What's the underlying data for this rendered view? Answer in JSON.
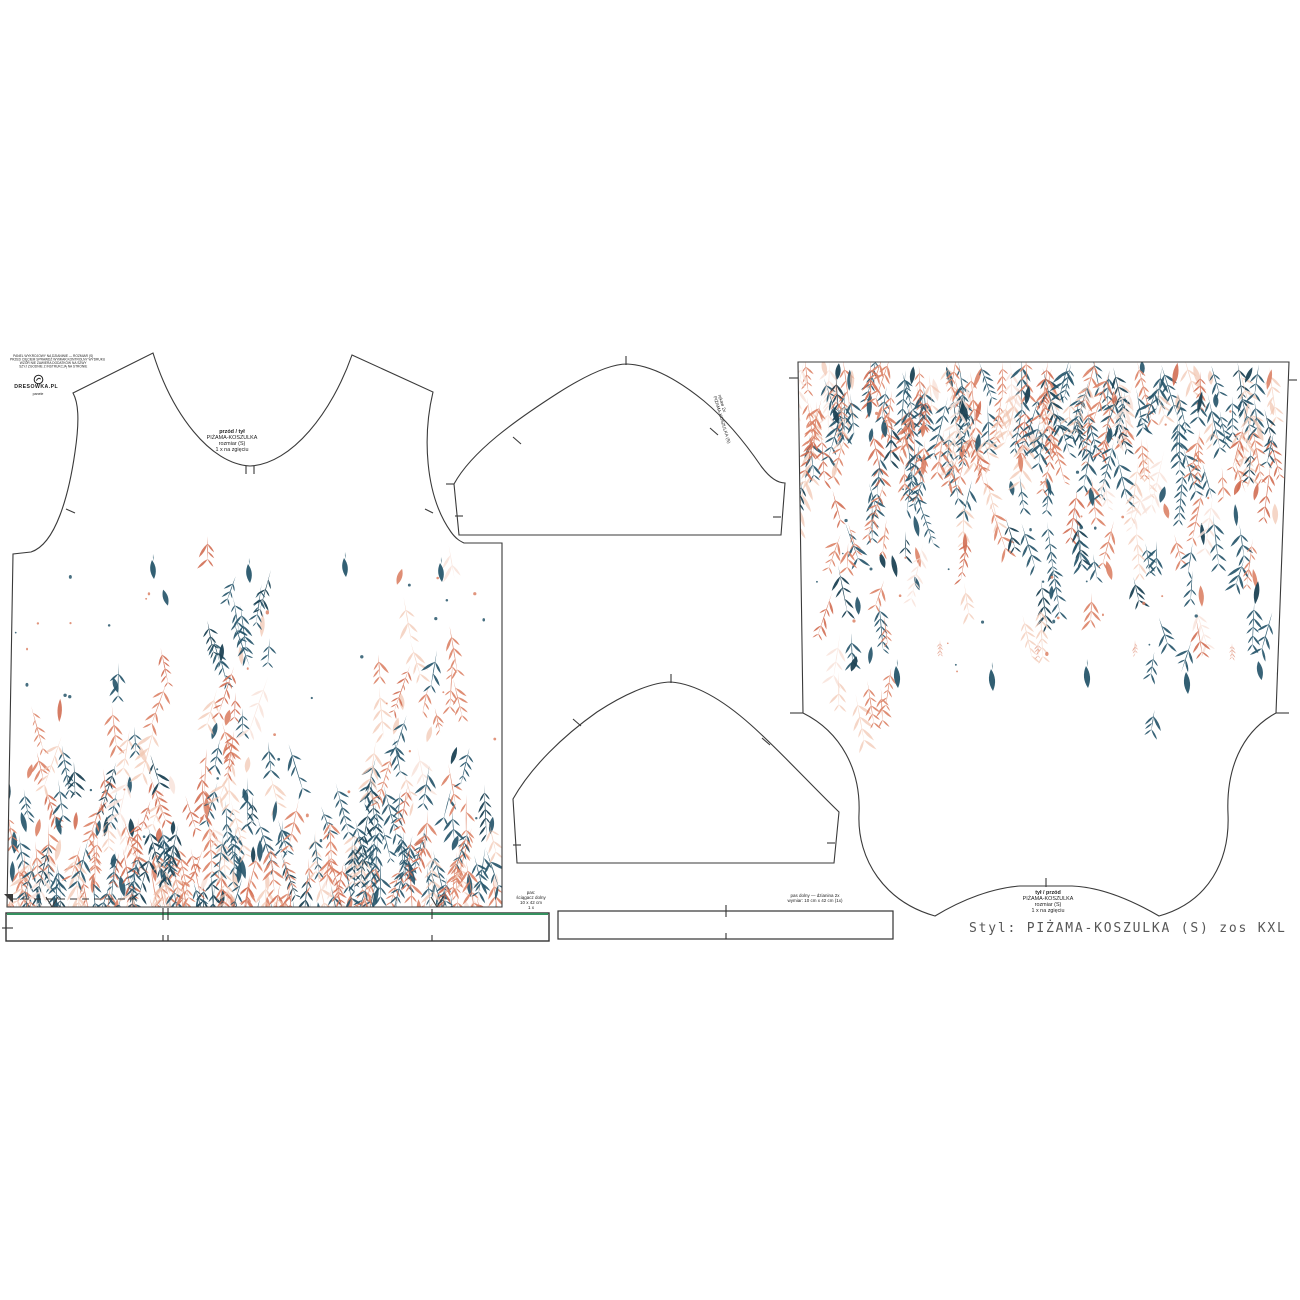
{
  "document": {
    "background": "#ffffff",
    "style_line": "Styl: PIŻAMA-KOSZULKA (S) zos KXL"
  },
  "branding": {
    "info_lines": [
      "PANEL WYKROJOWY NA DZIANINIE — ROZMIAR (S)",
      "PRZED CIĘCIEM SPRAWDŹ WYMIAR KONTROLNY WYDRUKU",
      "WZÓR NIE ZAWIERA DODATKÓW NA SZWY",
      "SZYJ ZGODNIE Z INSTRUKCJĄ NA STRONIE"
    ],
    "logo_text": "DRESOWKA.PL",
    "logo_sub": "panele"
  },
  "pieces": {
    "front_label": [
      "przód / tył",
      "PIŻAMA-KOSZULKA",
      "rozmiar (S)",
      "1 x na zgięciu"
    ],
    "sleeve_label": [
      "rękaw 2x",
      "PIŻAMA-KOSZULKA (S)"
    ],
    "back_label": [
      "tył / przód",
      "PIŻAMA-KOSZULKA",
      "rozmiar (S)",
      "1 x na zgięciu"
    ],
    "waistband_note": [
      "pas dolny — dzianina 2x",
      "wymiar: 10 cm x 42 cm (1x)"
    ],
    "left_band_note": [
      "pas:",
      "ściągacz dolny",
      "10 x 42 cm",
      "1 x"
    ]
  },
  "print": {
    "colors": {
      "teal": "#27566B",
      "teal_dark": "#1C4254",
      "coral": "#DC8266",
      "coral_deep": "#D06A4E",
      "peach": "#F1C6B1",
      "pale": "#F8E3DA"
    },
    "outline": "#3A3A3A",
    "green_edge": "#35915F"
  }
}
